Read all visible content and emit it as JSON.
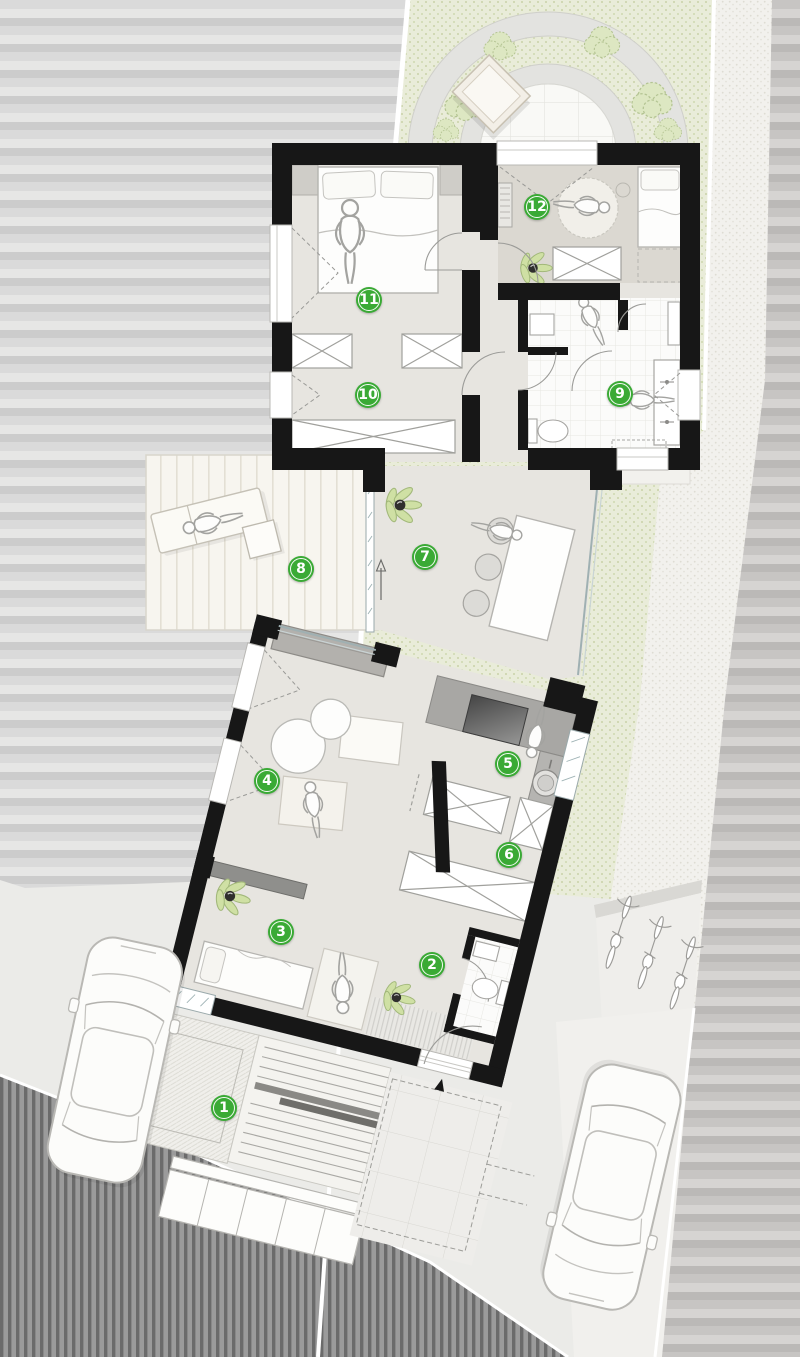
{
  "plan": {
    "marker_color": "#3aaa35",
    "markers": [
      {
        "n": "1",
        "x": 224,
        "y": 1108
      },
      {
        "n": "2",
        "x": 432,
        "y": 965
      },
      {
        "n": "3",
        "x": 281,
        "y": 932
      },
      {
        "n": "4",
        "x": 267,
        "y": 781
      },
      {
        "n": "5",
        "x": 508,
        "y": 764
      },
      {
        "n": "6",
        "x": 509,
        "y": 855
      },
      {
        "n": "7",
        "x": 425,
        "y": 557
      },
      {
        "n": "8",
        "x": 301,
        "y": 569
      },
      {
        "n": "9",
        "x": 620,
        "y": 394
      },
      {
        "n": "10",
        "x": 368,
        "y": 395
      },
      {
        "n": "11",
        "x": 369,
        "y": 300
      },
      {
        "n": "12",
        "x": 537,
        "y": 207
      }
    ],
    "palette": {
      "wall": "#171717",
      "lawn": "#e9ecd9",
      "floor": "#e7e5e0",
      "floor_dark": "#dbd8d1",
      "road_light": "#d9d9d7",
      "road_dark": "#6e6e6e",
      "deck": "#f6f4ee",
      "accent": "#3aaa35"
    }
  }
}
